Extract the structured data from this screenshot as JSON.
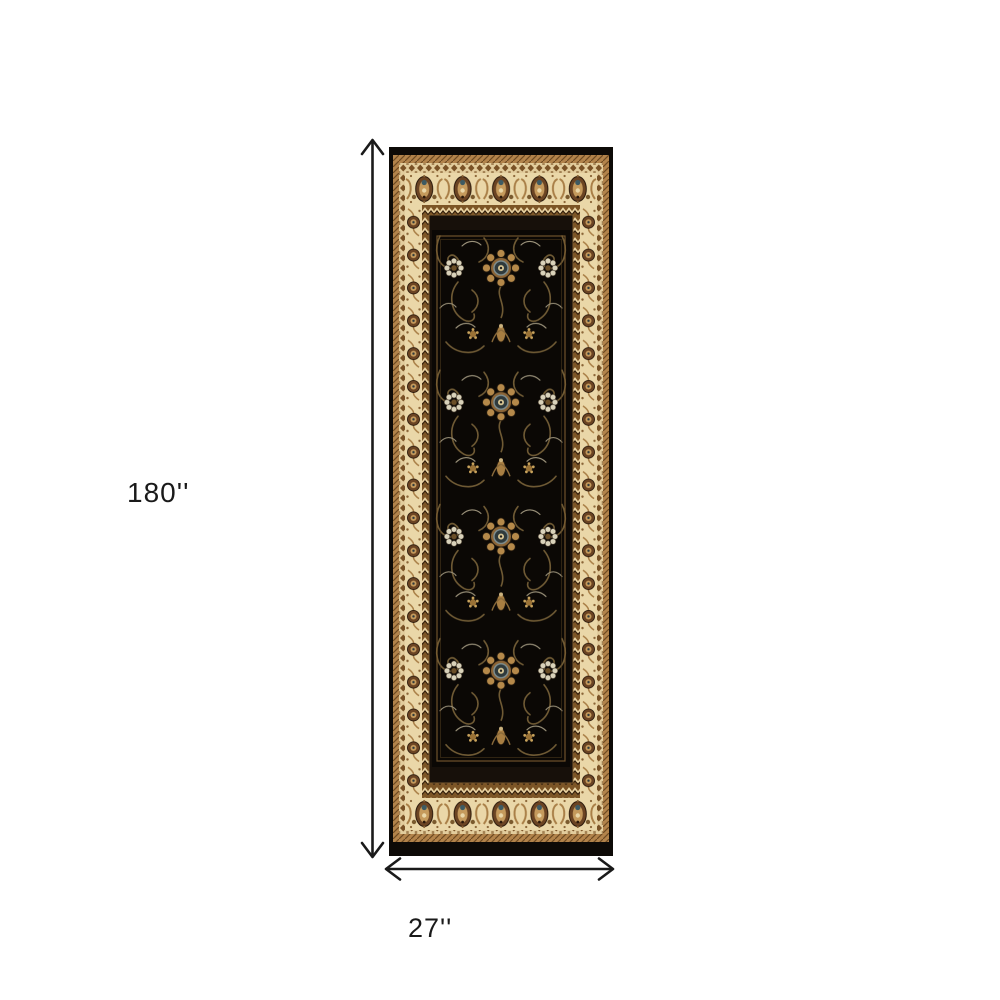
{
  "product_diagram": {
    "height_label": "180''",
    "width_label": "27''"
  },
  "rug": {
    "colors": {
      "edge_black": "#0d0a07",
      "field_black": "#0b0805",
      "border_cream": "#ead7a8",
      "band_tan": "#b2834b",
      "band_zigzag_brown": "#7c5526",
      "motif_brown_dark": "#6b4423",
      "motif_gold": "#b5894a",
      "accent_blue_grey": "#7e8e90",
      "vine_olive": "#6f5a34"
    }
  },
  "annotation": {
    "arrow_color": "#1a1a1a",
    "text_color": "#1a1a1a",
    "background": "#ffffff"
  }
}
